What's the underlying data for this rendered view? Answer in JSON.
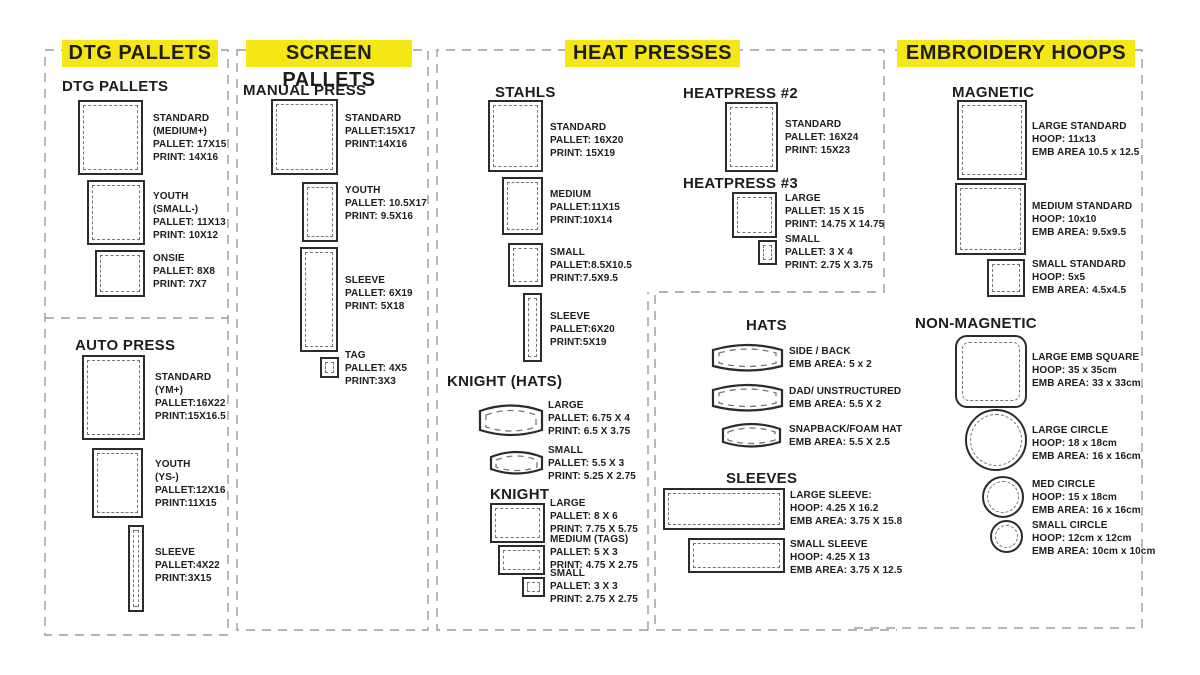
{
  "headers": {
    "dtg": "DTG PALLETS",
    "screen": "SCREEN PALLETS",
    "heat": "HEAT PRESSES",
    "embroidery": "EMBROIDERY HOOPS"
  },
  "colors": {
    "accent_yellow": "#F5E616",
    "ink": "#1D1D1B",
    "dash_gray": "#9B9B9B"
  },
  "groups": {
    "dtg_pallets": {
      "title": "DTG PALLETS",
      "items": [
        {
          "label": "STANDARD\n(MEDIUM+)\nPALLET: 17X15\nPRINT: 14X16"
        },
        {
          "label": "YOUTH\n(SMALL-)\nPALLET: 11X13\nPRINT: 10X12"
        },
        {
          "label": "ONSIE\nPALLET: 8X8\nPRINT: 7X7"
        }
      ]
    },
    "auto_press": {
      "title": "AUTO PRESS",
      "items": [
        {
          "label": "STANDARD\n(YM+)\nPALLET:16X22\nPRINT:15X16.5"
        },
        {
          "label": "YOUTH\n(YS-)\nPALLET:12X16\nPRINT:11X15"
        },
        {
          "label": "SLEEVE\nPALLET:4X22\nPRINT:3X15"
        }
      ]
    },
    "manual_press": {
      "title": "MANUAL PRESS",
      "items": [
        {
          "label": "STANDARD\nPALLET:15X17\nPRINT:14X16"
        },
        {
          "label": "YOUTH\nPALLET: 10.5X17\nPRINT: 9.5X16"
        },
        {
          "label": "SLEEVE\nPALLET: 6X19\nPRINT: 5X18"
        },
        {
          "label": "TAG\nPALLET: 4X5\nPRINT:3X3"
        }
      ]
    },
    "stahls": {
      "title": "STAHLS",
      "items": [
        {
          "label": "STANDARD\nPALLET: 16X20\nPRINT: 15X19"
        },
        {
          "label": "MEDIUM\nPALLET:11X15\nPRINT:10X14"
        },
        {
          "label": "SMALL\nPALLET:8.5X10.5\nPRINT:7.5X9.5"
        },
        {
          "label": "SLEEVE\nPALLET:6X20\nPRINT:5X19"
        }
      ]
    },
    "knight_hats": {
      "title": "KNIGHT (HATS)",
      "items": [
        {
          "label": "LARGE\nPALLET: 6.75 X 4\nPRINT: 6.5 X 3.75"
        },
        {
          "label": "SMALL\nPALLET: 5.5 X 3\nPRINT: 5.25 X 2.75"
        }
      ]
    },
    "knight": {
      "title": "KNIGHT",
      "items": [
        {
          "label": "LARGE\nPALLET: 8 X 6\nPRINT: 7.75 X 5.75"
        },
        {
          "label": "MEDIUM (TAGS)\nPALLET: 5 X 3\nPRINT: 4.75 X 2.75"
        },
        {
          "label": "SMALL\nPALLET: 3 X 3\nPRINT: 2.75 X 2.75"
        }
      ]
    },
    "heatpress2": {
      "title": "HEATPRESS #2",
      "items": [
        {
          "label": "STANDARD\nPALLET: 16X24\nPRINT: 15X23"
        }
      ]
    },
    "heatpress3": {
      "title": "HEATPRESS #3",
      "items": [
        {
          "label": "LARGE\nPALLET: 15 X 15\nPRINT: 14.75 X 14.75"
        },
        {
          "label": "SMALL\nPALLET: 3 X 4\nPRINT: 2.75 X 3.75"
        }
      ]
    },
    "hats": {
      "title": "HATS",
      "items": [
        {
          "label": "SIDE / BACK\nEMB AREA: 5 x 2"
        },
        {
          "label": "DAD/ UNSTRUCTURED\nEMB AREA: 5.5 X 2"
        },
        {
          "label": "SNAPBACK/FOAM HAT\nEMB AREA: 5.5 X 2.5"
        }
      ]
    },
    "sleeves": {
      "title": "SLEEVES",
      "items": [
        {
          "label": "LARGE SLEEVE:\nHOOP: 4.25 X 16.2\nEMB AREA: 3.75 X 15.8"
        },
        {
          "label": "SMALL SLEEVE\nHOOP: 4.25 X 13\nEMB AREA: 3.75 X 12.5"
        }
      ]
    },
    "magnetic": {
      "title": "MAGNETIC",
      "items": [
        {
          "label": "LARGE STANDARD\nHOOP: 11x13\nEMB AREA 10.5 x 12.5"
        },
        {
          "label": "MEDIUM STANDARD\nHOOP: 10x10\nEMB AREA: 9.5x9.5"
        },
        {
          "label": "SMALL STANDARD\nHOOP: 5x5\nEMB AREA: 4.5x4.5"
        }
      ]
    },
    "non_magnetic": {
      "title": "NON-MAGNETIC",
      "items": [
        {
          "label": "LARGE EMB SQUARE\nHOOP: 35 x 35cm\nEMB AREA: 33 x 33cm"
        },
        {
          "label": "LARGE CIRCLE\nHOOP: 18 x 18cm\nEMB AREA: 16 x 16cm"
        },
        {
          "label": "MED CIRCLE\nHOOP: 15 x 18cm\nEMB AREA: 16 x 16cm"
        },
        {
          "label": "SMALL CIRCLE\nHOOP: 12cm x 12cm\nEMB AREA: 10cm x 10cm"
        }
      ]
    }
  }
}
